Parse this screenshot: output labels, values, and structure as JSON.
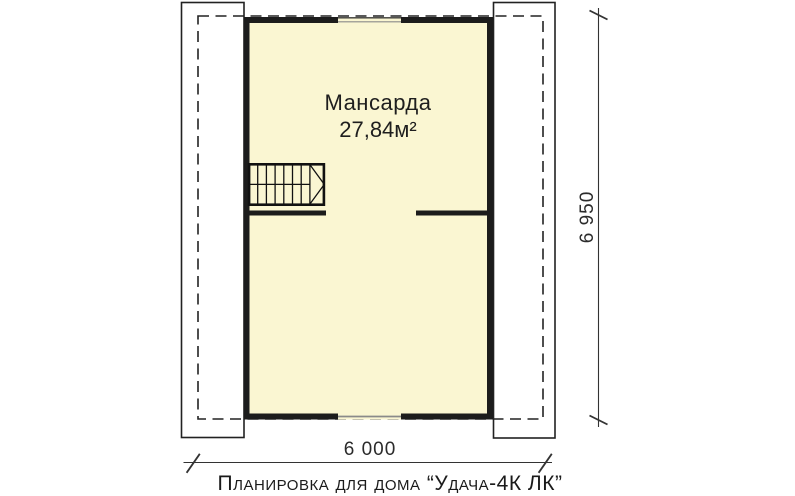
{
  "plan": {
    "room": {
      "name": "Мансарда",
      "area": "27,84м²"
    }
  },
  "dimensions": {
    "height": "6 950",
    "width": "6 000"
  },
  "caption": "Планировка для дома “Удача-4К ЛК”",
  "colors": {
    "background": "#FFFFFF",
    "room_fill": "#FAF6D2",
    "wall": "#1C1C1C",
    "outline": "#222222",
    "window": "#8A8A8A",
    "dim_line": "#333333",
    "text": "#1E1E1E"
  }
}
